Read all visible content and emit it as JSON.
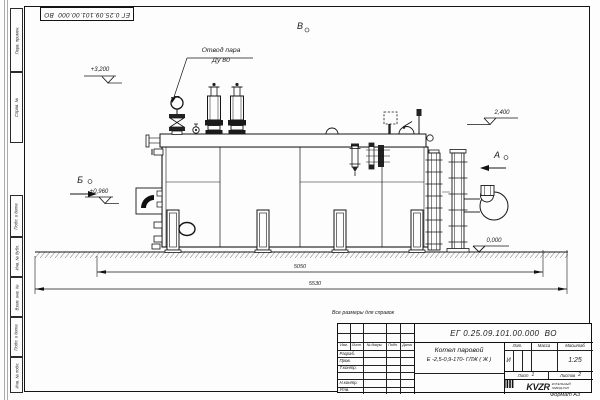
{
  "frame": {
    "stamp": "ЕГ 0.25.09.101.00.000  ВО",
    "format_note": "Формат А3",
    "margin_top": [
      "Перв. примен.",
      "Справ. №"
    ],
    "margin_bottom": [
      "Подп. и дата",
      "Инв. № дубл.",
      "Взам. инв. №",
      "Подп. и дата",
      "Инв. № подл."
    ]
  },
  "drawing": {
    "callout_steam_line1": "Отвод пара",
    "callout_steam_line2": "Ду 80",
    "view_b": "Б",
    "view_v": "В",
    "view_a": "А",
    "elev_3200": "+3,200",
    "elev_0960": "+0,960",
    "elev_2400": "2,400",
    "elev_0000": "0,000",
    "dim_5050": "5050",
    "dim_5530": "5530"
  },
  "title_block": {
    "note": "Все размеры для справок",
    "doc_number": "ЕГ 0.25.09.101.00.000  ВО",
    "product_name": "Котел паровой",
    "product_type": "Е -2,5-0,9-170- ГЛЖ ( Ж )",
    "col_izm": "Изм.",
    "col_list": "Лист",
    "col_doc": "№ докум.",
    "col_sign": "Подп.",
    "col_date": "Дата",
    "row_razrab": "Разраб.",
    "row_prov": "Пров.",
    "row_tkontr": "Т.контр.",
    "row_nkontr": "Н.контр.",
    "row_utv": "Утв.",
    "lit_header": "Лит.",
    "mass_header": "Масса",
    "scale_header": "Масштаб",
    "lit_value": "И",
    "scale_value": "1:25",
    "sheet_label": "Лист",
    "sheet_value": "1",
    "sheets_label": "Листов",
    "sheets_value": "2",
    "logo": "KVZR",
    "logo_caption1": "КОТЕЛЬНЫЙ",
    "logo_caption2": "ЗАВОД РЭП"
  }
}
